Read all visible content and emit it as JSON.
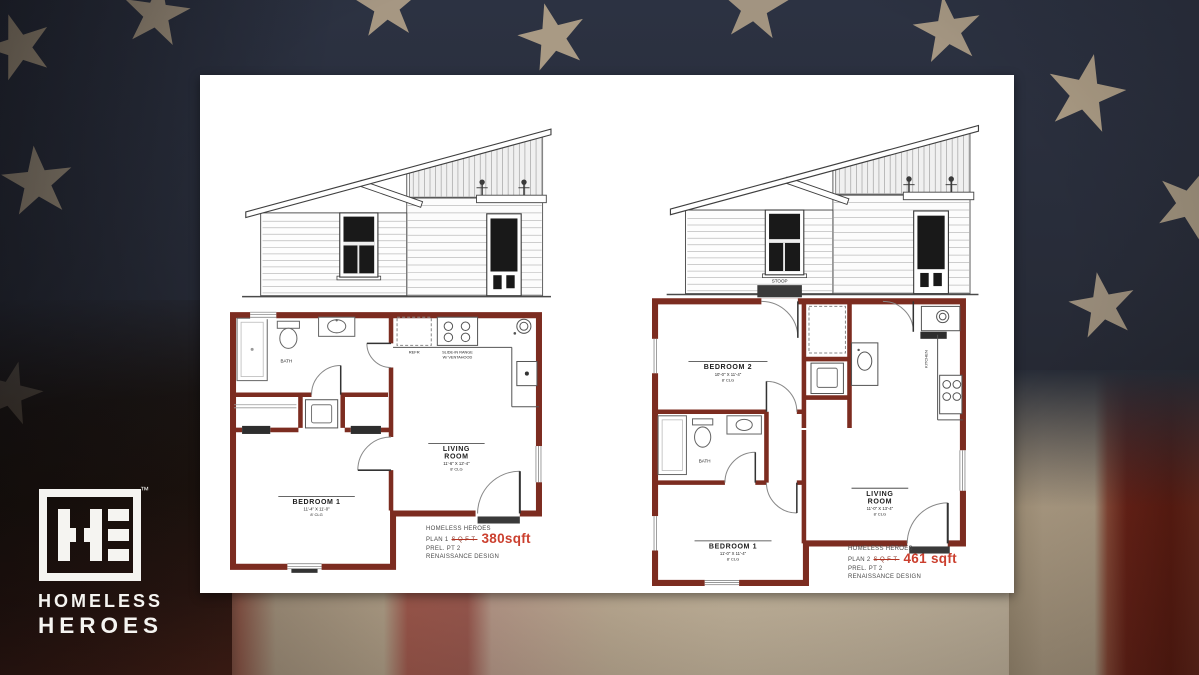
{
  "logo": {
    "monogram": "HE",
    "trademark": "™",
    "title_line1": "HOMELESS",
    "title_line2": "HEROES"
  },
  "colors": {
    "flag_navy": "#272c37",
    "flag_star_tan": "#b7a68c",
    "flag_red": "#6d2318",
    "flag_tan": "#b3a28a",
    "plan_wall_red": "#7c2c20",
    "area_accent_red": "#cb3f2e"
  },
  "plan1": {
    "caption_l1": "HOMELESS HEROES",
    "caption_plan": "PLAN 1",
    "caption_struck": "SQFT",
    "caption_area": "380sqft",
    "caption_l3": "PREL. PT 2",
    "caption_l4": "RENAISSANCE DESIGN",
    "bedroom": "BEDROOM 1",
    "bedroom_dims": "11'-4\" X 11'-0\"",
    "living_1": "LIVING",
    "living_2": "ROOM",
    "living_dims": "11'-6\" X 12'-4\"",
    "clg": "8' CLG",
    "bath": "BATH",
    "refr": "REFR",
    "range_1": "SLIDE-IN RANGE",
    "range_2": "W/ VENTAHOOD"
  },
  "plan2": {
    "caption_l1": "HOMELESS HEROES",
    "caption_plan": "PLAN 2",
    "caption_struck": "SQFT",
    "caption_area": "461 sqft",
    "caption_l3": "PREL. PT 2",
    "caption_l4": "RENAISSANCE DESIGN",
    "bedroom1": "BEDROOM 1",
    "bedroom1_dims": "11'-0\" X 11'-4\"",
    "bedroom2": "BEDROOM 2",
    "bedroom2_dims": "10'-0\" X 11'-4\"",
    "living_1": "LIVING",
    "living_2": "ROOM",
    "living_dims": "11'-0\" X 13'-4\"",
    "clg": "8' CLG",
    "bath": "BATH",
    "kitchen": "KITCHEN",
    "stoop": "STOOP"
  }
}
